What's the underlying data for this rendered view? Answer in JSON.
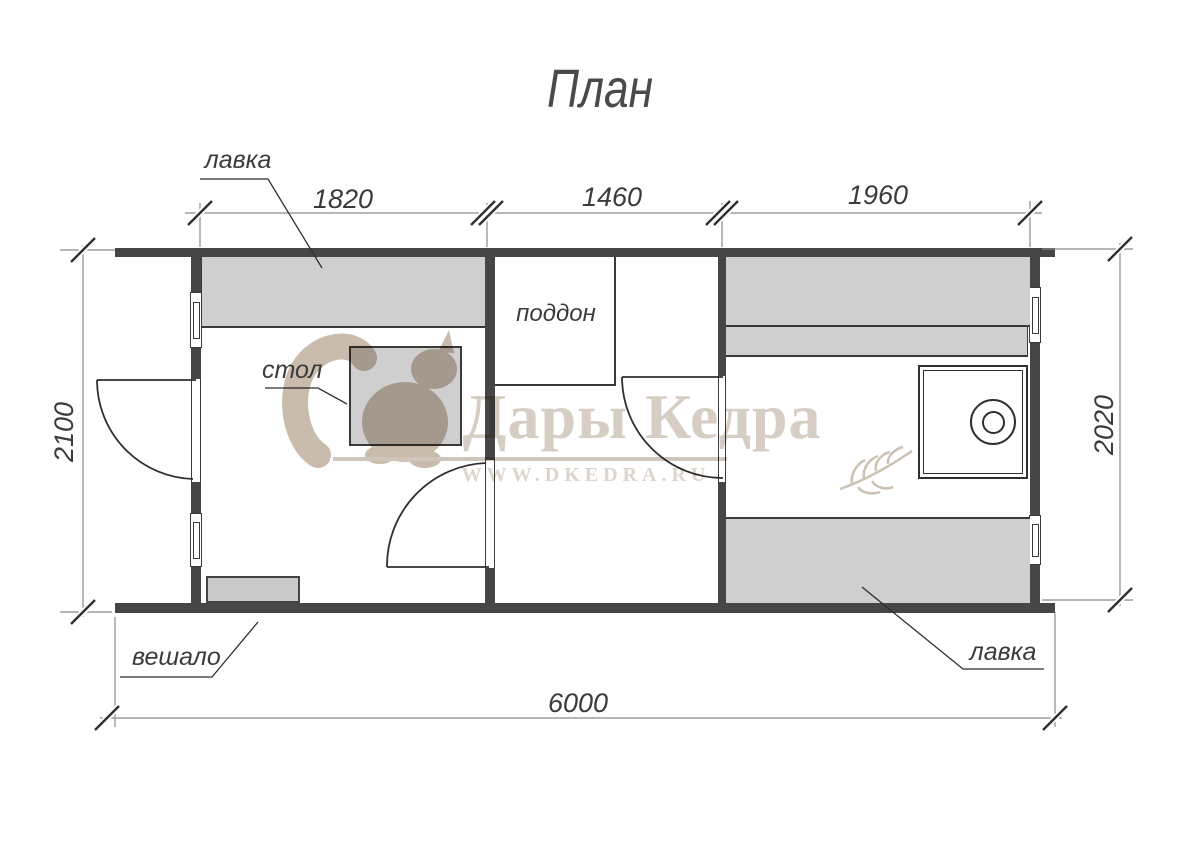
{
  "title": "План",
  "labels": {
    "bench_top": "лавка",
    "table": "стол",
    "shower_tray": "поддон",
    "hanger": "вешало",
    "bench_bottom": "лавка"
  },
  "dimensions": {
    "top_segments": [
      "1820",
      "1460",
      "1960"
    ],
    "left_width": "2100",
    "right_width": "2020",
    "total_length": "6000"
  },
  "watermark": {
    "brand": "Дары Кедра",
    "website": "WWW.DKEDRA.RU",
    "logo_icon": "squirrel-logo",
    "decor_icon": "wheat-sprig"
  },
  "colors": {
    "wall": "#464646",
    "bench_fill": "#cfcfcf",
    "drawing_line": "#2f2f2f",
    "dimension_line": "#8a8a8a",
    "watermark_beige": "#d7cec3"
  }
}
